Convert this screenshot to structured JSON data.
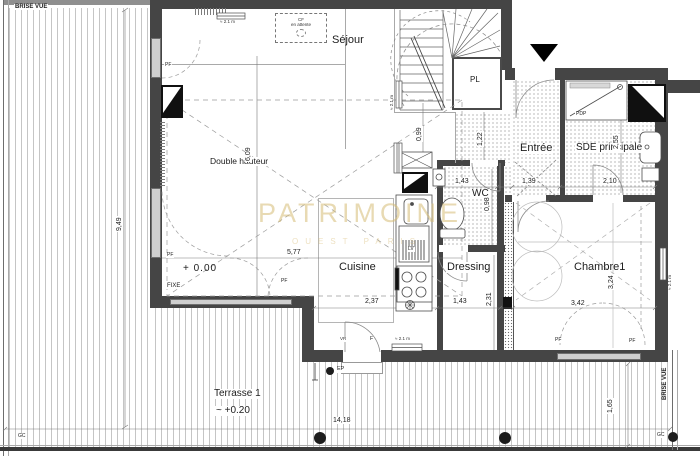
{
  "meta": {
    "type": "architectural floor plan"
  },
  "watermark": {
    "title": "PATRIMOINE",
    "subtitle": "OUEST PARIS"
  },
  "rooms": {
    "sejour": "Séjour",
    "double_hauteur": "Double hauteur",
    "cuisine": "Cuisine",
    "dressing": "Dressing",
    "chambre1": "Chambre1",
    "entree": "Entrée",
    "sde_principale": "SDE principale",
    "wc": "WC",
    "pl": "PL",
    "terrasse": "Terrasse 1"
  },
  "levels": {
    "floor": "+ 0.00",
    "terrace": "~ +0.20"
  },
  "dims": {
    "d609": "6,09",
    "d577": "5,77",
    "d237": "2,37",
    "d143": "1,43",
    "d231": "2,31",
    "d098": "0,98",
    "d139": "1,39",
    "d210": "2,10",
    "d255": "2,55",
    "d122": "1,22",
    "d099": "0,99",
    "d342": "3,42",
    "d324": "3,24",
    "d949": "9,49",
    "d1418": "14,18",
    "d165": "1,65"
  },
  "labels": {
    "brise_vue": "BRISE VUE",
    "fixe": "FIXE",
    "pf": "PF",
    "pdp": "PDP",
    "ep": "EP",
    "gc": "GC",
    "lv": "LV",
    "f": "F",
    "vr": "VR",
    "cf_line1": "CF",
    "cf_line2": "en attente",
    "h21": "≈ 2.1 m"
  }
}
